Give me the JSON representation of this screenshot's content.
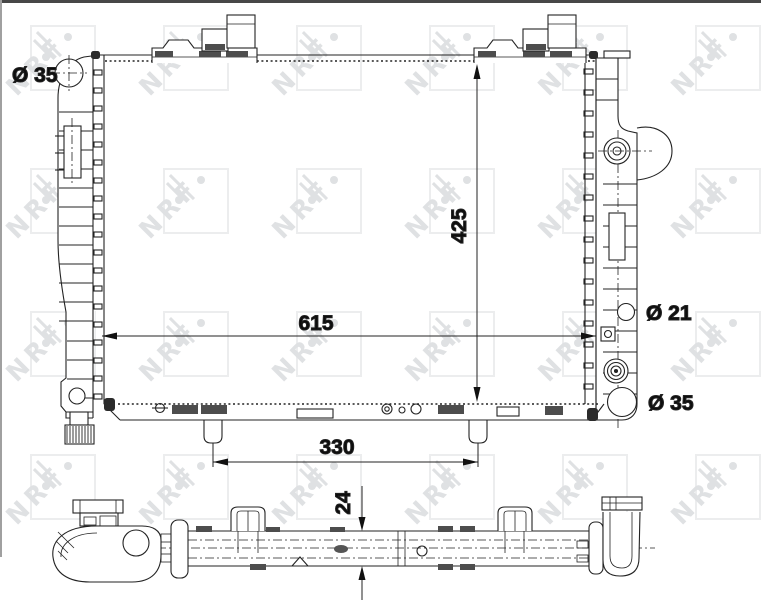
{
  "drawing": {
    "kind": "radiator technical drawing",
    "brand_watermark": "NRF"
  },
  "labels": {
    "inlet_top_left": "Ø 35",
    "port_right_upper": "Ø 21",
    "port_right_lower": "Ø 35"
  },
  "dimensions": {
    "core_width": "615",
    "core_height": "425",
    "mount_pin_spacing": "330",
    "core_thickness": "24"
  },
  "watermark": {
    "letters": "NRF",
    "square_color": "#ecedee",
    "glyph_color": "#dfe1e3"
  },
  "colors": {
    "line": "#232323",
    "background": "#ffffff",
    "top_border": "#474747",
    "left_border": "#a0a0a0"
  }
}
